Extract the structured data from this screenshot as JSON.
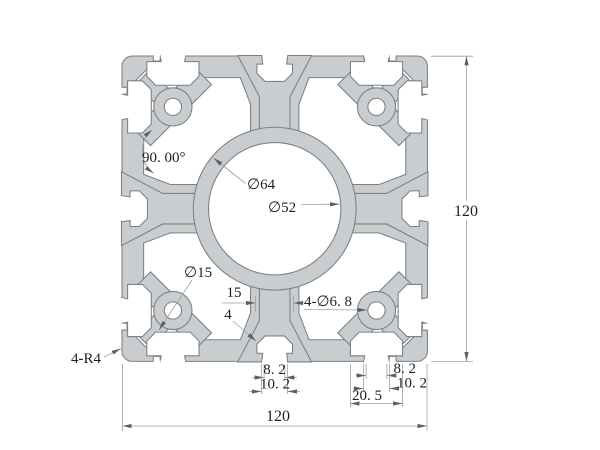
{
  "drawing": {
    "type": "aluminum-extrusion-profile-cross-section",
    "dimensions": {
      "angle": "90. 00°",
      "center_bore_outer": "∅64",
      "center_bore": "∅52",
      "corner_boss": "∅15",
      "web_width": "15",
      "wall_thickness": "4",
      "corner_holes": "4-∅6. 8",
      "corner_radius": "4-R4",
      "overall_height": "120",
      "overall_width": "120",
      "center_slot_mouth": "8. 2",
      "center_slot_outer": "10. 2",
      "corner_slot_mouth": "8. 2",
      "corner_slot_outer": "10. 2",
      "corner_slot_head": "20. 5"
    },
    "colors": {
      "profile_fill": "#c9cdd0",
      "profile_outline": "#7b8184",
      "dimension_line": "#9aa1a5",
      "arrow": "#5a6065",
      "text": "#1c2023",
      "background": "#ffffff"
    }
  }
}
